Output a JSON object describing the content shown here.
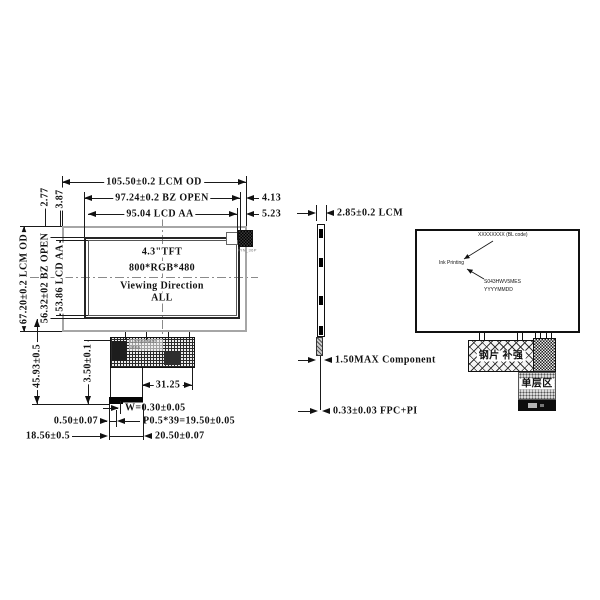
{
  "front": {
    "dim_lcm_w": "105.50±0.2 LCM OD",
    "dim_bz_w": "97.24±0.2 BZ OPEN",
    "dim_lcd_w": "95.04 LCD AA",
    "off_bz_r": "4.13",
    "off_lcd_r": "5.23",
    "dim_lcm_h": "67.20±0.2 LCM OD",
    "dim_bz_h": "56.32±02 BZ OPEN",
    "dim_lcd_h": "53.86 LCD AA",
    "off_bz_t": "2.77",
    "off_lcd_t": "3.87",
    "dim_total": "45.93±0.5",
    "dim_fpc_len": "3.50±0.1",
    "dim_comp": "31.25",
    "dim_finger_w": "W=0.30±0.05",
    "dim_finger_gap": "0.50±0.07",
    "dim_pitch": "P0.5*39=19.50±0.05",
    "dim_fpc_off": "18.56±0.5",
    "dim_fpc_w": "20.50±0.07",
    "panel_size": "4.3\"TFT",
    "panel_res": "800*RGB*480",
    "viewing_dir": "Viewing Direction",
    "viewing_all": "ALL",
    "component_label": "Component area",
    "connector_label": "PIN_36P"
  },
  "side": {
    "dim_lcm_t": "2.85±0.2 LCM",
    "dim_comp_t": "1.50MAX Component",
    "dim_fpc_t": "0.33±0.03 FPC+PI"
  },
  "back": {
    "bl_code": "XXXXXXXX (BL code)",
    "ink_printing": "Ink Printing",
    "model_code": "S043HWV5MES",
    "date_code": "YYYYMMDD",
    "steel_label": "钢片 补强",
    "single_layer_label": "单层区"
  }
}
